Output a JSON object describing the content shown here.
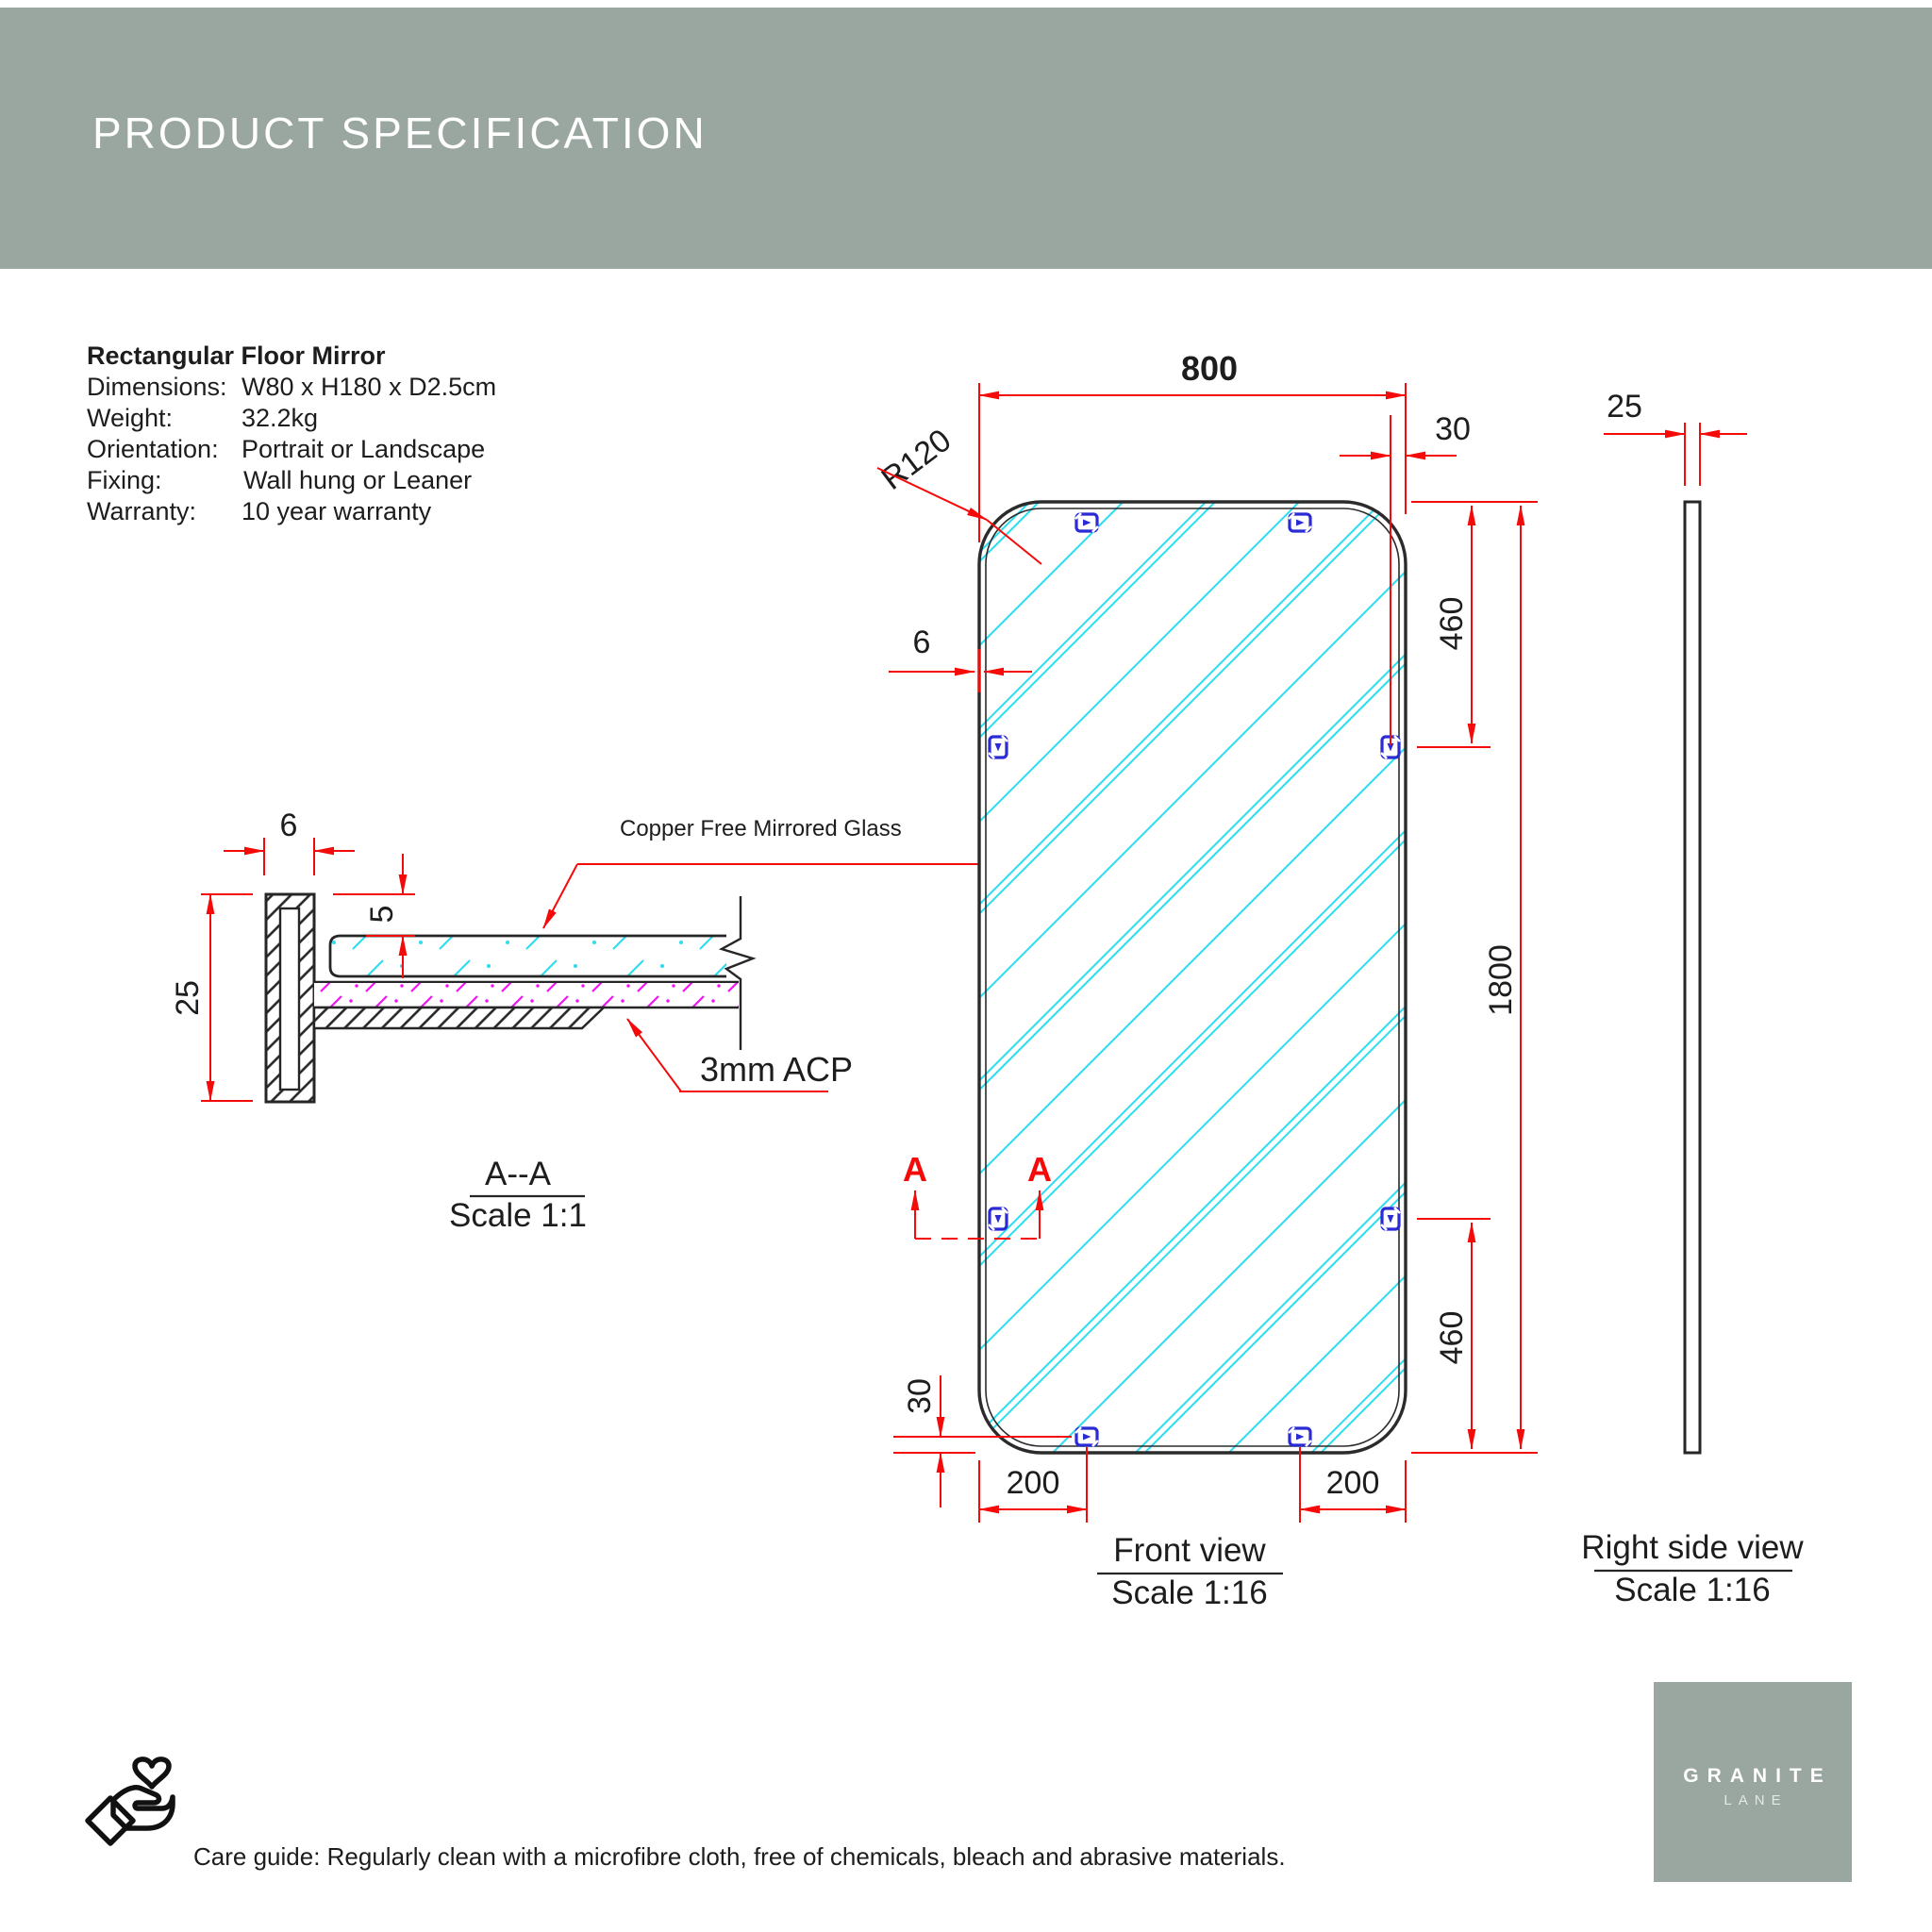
{
  "header": {
    "title": "PRODUCT SPECIFICATION"
  },
  "product": {
    "name": "Rectangular Floor Mirror",
    "specs": [
      {
        "label": "Dimensions:",
        "value": "W80 x H180 x D2.5cm"
      },
      {
        "label": "Weight:",
        "value": "32.2kg"
      },
      {
        "label": "Orientation:",
        "value": "Portrait or Landscape"
      },
      {
        "label": "Fixing:",
        "value": "Wall hung or Leaner"
      },
      {
        "label": "Warranty:",
        "value": "10 year warranty"
      }
    ]
  },
  "section_view": {
    "title": "A--A",
    "scale": "Scale 1:1",
    "glass_label": "Copper Free Mirrored Glass",
    "acp_label": "3mm ACP",
    "dim_frame_width": "6",
    "dim_frame_depth": "25",
    "dim_glass_inset": "5"
  },
  "front_view": {
    "title": "Front view",
    "scale": "Scale 1:16",
    "section_marker": "A",
    "dim_width": "800",
    "dim_height": "1800",
    "dim_corner_radius": "R120",
    "dim_frame_face": "6",
    "dim_clip_edge_top": "30",
    "dim_clip_edge_bottom": "30",
    "dim_clip_top": "460",
    "dim_clip_bottom": "460",
    "dim_clip_left": "200",
    "dim_clip_right": "200"
  },
  "side_view": {
    "title": "Right side view",
    "scale": "Scale 1:16",
    "dim_depth": "25"
  },
  "footer": {
    "care_guide": "Care guide:  Regularly clean with a microfibre cloth, free of chemicals, bleach and abrasive materials."
  },
  "brand": {
    "name": "GRANITE",
    "sub": "LANE"
  },
  "colors": {
    "banner": "#9AA6A0",
    "dimension_red": "#F50A0A",
    "hatch_cyan": "#2BDEEF",
    "hatch_magenta": "#F312F3",
    "clip_blue": "#2B2BD5",
    "line_black": "#262626"
  }
}
